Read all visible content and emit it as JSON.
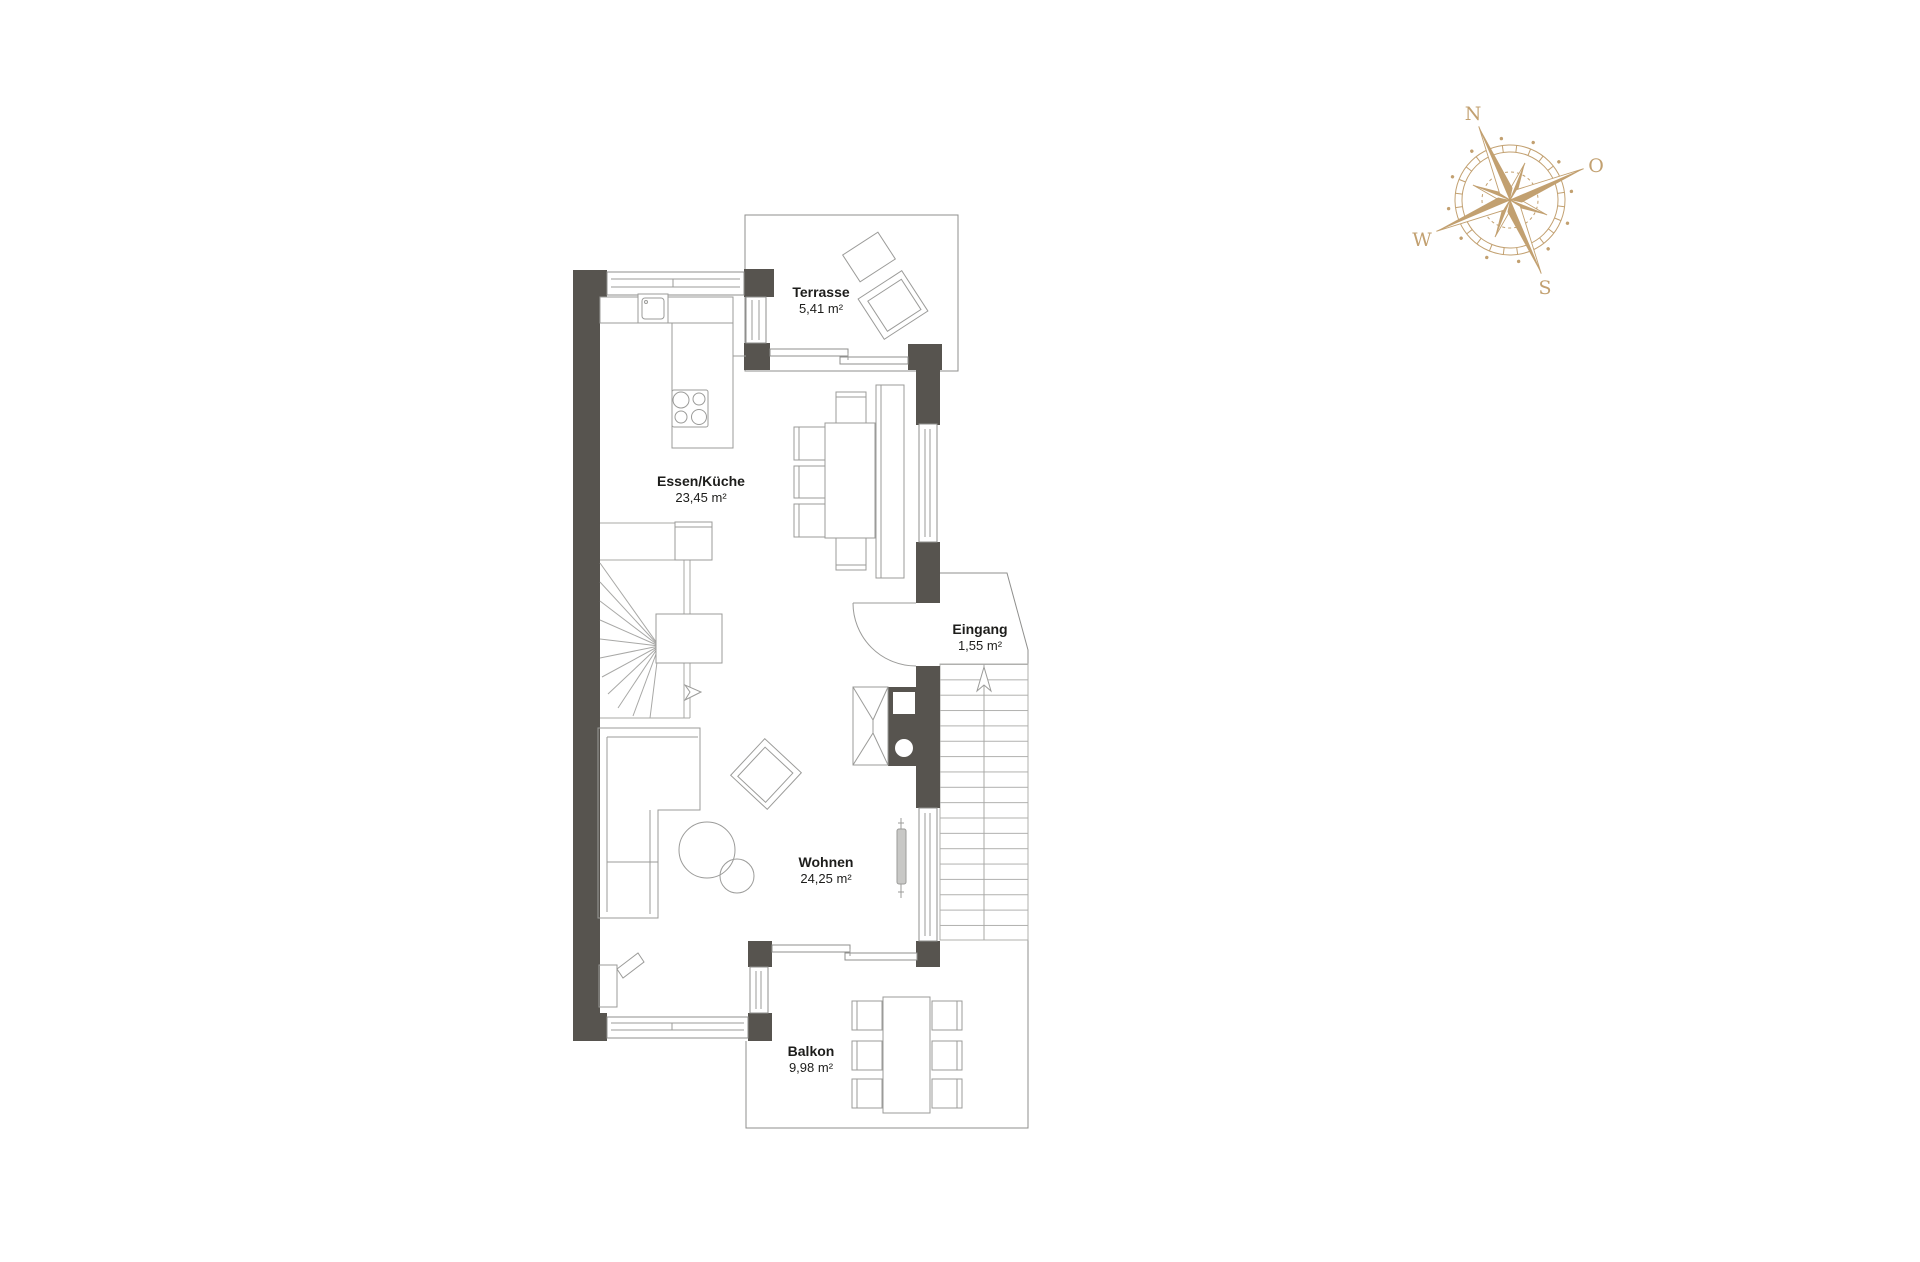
{
  "floorplan": {
    "rooms": [
      {
        "id": "terrasse",
        "label": "Terrasse",
        "area": "5,41 m²"
      },
      {
        "id": "essen-kueche",
        "label": "Essen/Küche",
        "area": "23,45 m²"
      },
      {
        "id": "eingang",
        "label": "Eingang",
        "area": "1,55 m²"
      },
      {
        "id": "wohnen",
        "label": "Wohnen",
        "area": "24,25 m²"
      },
      {
        "id": "balkon",
        "label": "Balkon",
        "area": "9,98 m²"
      }
    ],
    "colors": {
      "wall": "#57544F",
      "furniture_line": "#9b9b99",
      "outline": "#8f8f8d",
      "label_text": "#1d1d1b",
      "background": "#ffffff"
    }
  },
  "compass": {
    "icon": "compass-rose-icon",
    "color": "#C2A070",
    "directions": {
      "north": "N",
      "east": "O",
      "south": "S",
      "west": "W"
    }
  }
}
